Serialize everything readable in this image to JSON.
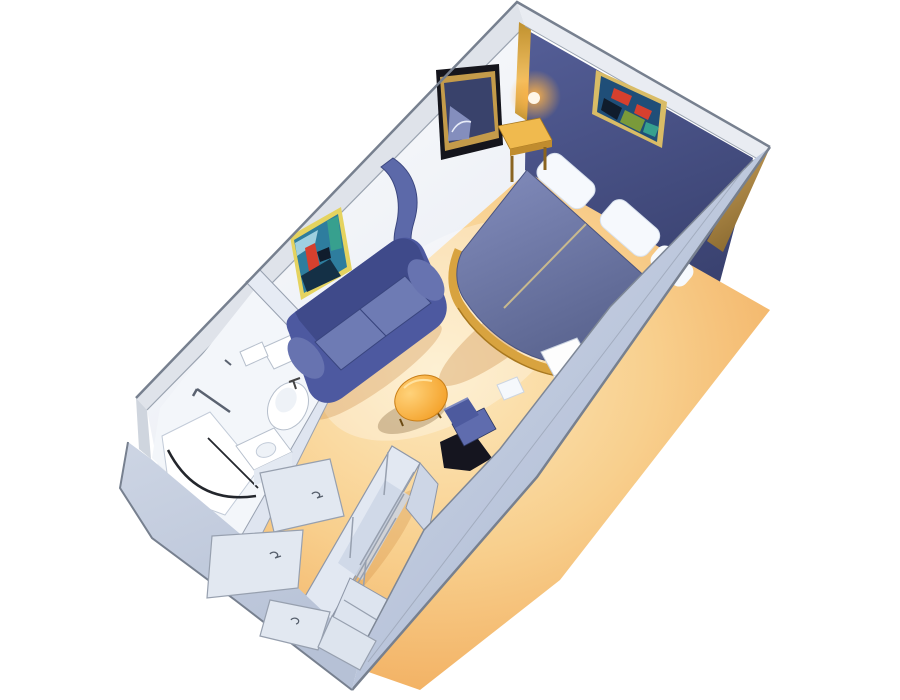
{
  "canvas": {
    "width": 900,
    "height": 700,
    "background": "#ffffff"
  },
  "scene": {
    "type": "isometric-3d-floorplan",
    "subject": "cruise-ship-interior-stateroom",
    "items": [
      "headboard-accent-wall",
      "wall-art-bedroom",
      "wall-sconce-lamp",
      "tv",
      "nightstand",
      "twin-bed-left",
      "twin-bed-right",
      "pillows",
      "curved-partition",
      "sofa",
      "wall-art-sitting-area",
      "coffee-table",
      "desk-chair",
      "vanity-desk",
      "vanity-stool",
      "bathroom",
      "toilet",
      "sink-counter",
      "shower",
      "towel-bars",
      "wardrobe-shelves",
      "bathroom-door",
      "mirror-panel",
      "entry-door",
      "corridor"
    ]
  },
  "colors": {
    "background": "#ffffff",
    "outline_dark": "#77808f",
    "outline_soft": "#9aa3b0",
    "wall_top": "#dfe3ea",
    "wall_top_light": "#e9ecf2",
    "wall_white_hi": "#ffffff",
    "wall_white_lo": "#e7ebf3",
    "corner_post": "#cfd5de",
    "navy_hi": "#545e97",
    "navy_lo": "#39416f",
    "gold_hi": "#f2c063",
    "gold_lo": "#c0912f",
    "gold_top": "#f0ba4e",
    "gold_edge": "#c08c2e",
    "gold_leg": "#8a6420",
    "tan_hi": "#c9a05a",
    "tan_lo": "#8a6a30",
    "lamp_glow": "#ffb347",
    "lamp_core": "#fff7e8",
    "floor_hi": "#fdeac0",
    "floor_mid": "#f8cf8d",
    "floor_lo": "#ef9f4a",
    "carpet_shadow": "#c77f33",
    "band_hi": "#d3dbea",
    "band_lo": "#b2bed6",
    "band_sw_hi": "#cdd5e4",
    "band_sw_lo": "#b6c1d6",
    "bed_hi": "#838dbd",
    "bed_lo": "#5a648f",
    "bed_base": "#d8a33f",
    "bed_seam": "#c8b98e",
    "pillow": "#f6f9fd",
    "tv_black": "#15151c",
    "tv_gold": "#c49b4a",
    "tv_screen": "#39426b",
    "tv_reflect": "#8d97c6",
    "partition_blue": "#5c69a9",
    "sofa_base": "#4d59a0",
    "sofa_dark": "#3f4a8a",
    "sofa_cushion": "#6e7bb4",
    "sofa_arm": "#6773b0",
    "table_hi": "#ffd27a",
    "table_lo": "#f2991c",
    "table_shadow": "#a98e66",
    "chair_blue": "#5f6cae",
    "chair_back": "#4d5a9e",
    "chair_shadow": "#15151f",
    "vanity_white": "#fdfdfd",
    "vanity_face": "#e7ecf4",
    "bath_floor": "#f3f6fa",
    "bath_wall": "#e6ebf4",
    "bath_wall2": "#dfe5f0",
    "fixture_white": "#ffffff",
    "fixture_line": "#b6bfcc",
    "fixture_inner": "#eef2f7",
    "dark_line": "#23262c",
    "metal": "#5a6270",
    "wardrobe_rail": "#e2e8f2",
    "wardrobe_panel": "#cdd6e6",
    "wardrobe_lower": "#dde4ef",
    "wardrobe_line": "#97a0af",
    "door_panel": "#e2e8f1",
    "art_frame_gold": "#d9bc66",
    "art_frame_yellow": "#e5d35f",
    "art_navy": "#1f4e78",
    "art_teal": "#2e7d9e",
    "art_red": "#d6402e",
    "art_green": "#7a9a3a",
    "art_lightblue": "#9fd0e0",
    "art_dark": "#143046",
    "art_black": "#101c2c",
    "art_tealgreen": "#37a08e"
  }
}
